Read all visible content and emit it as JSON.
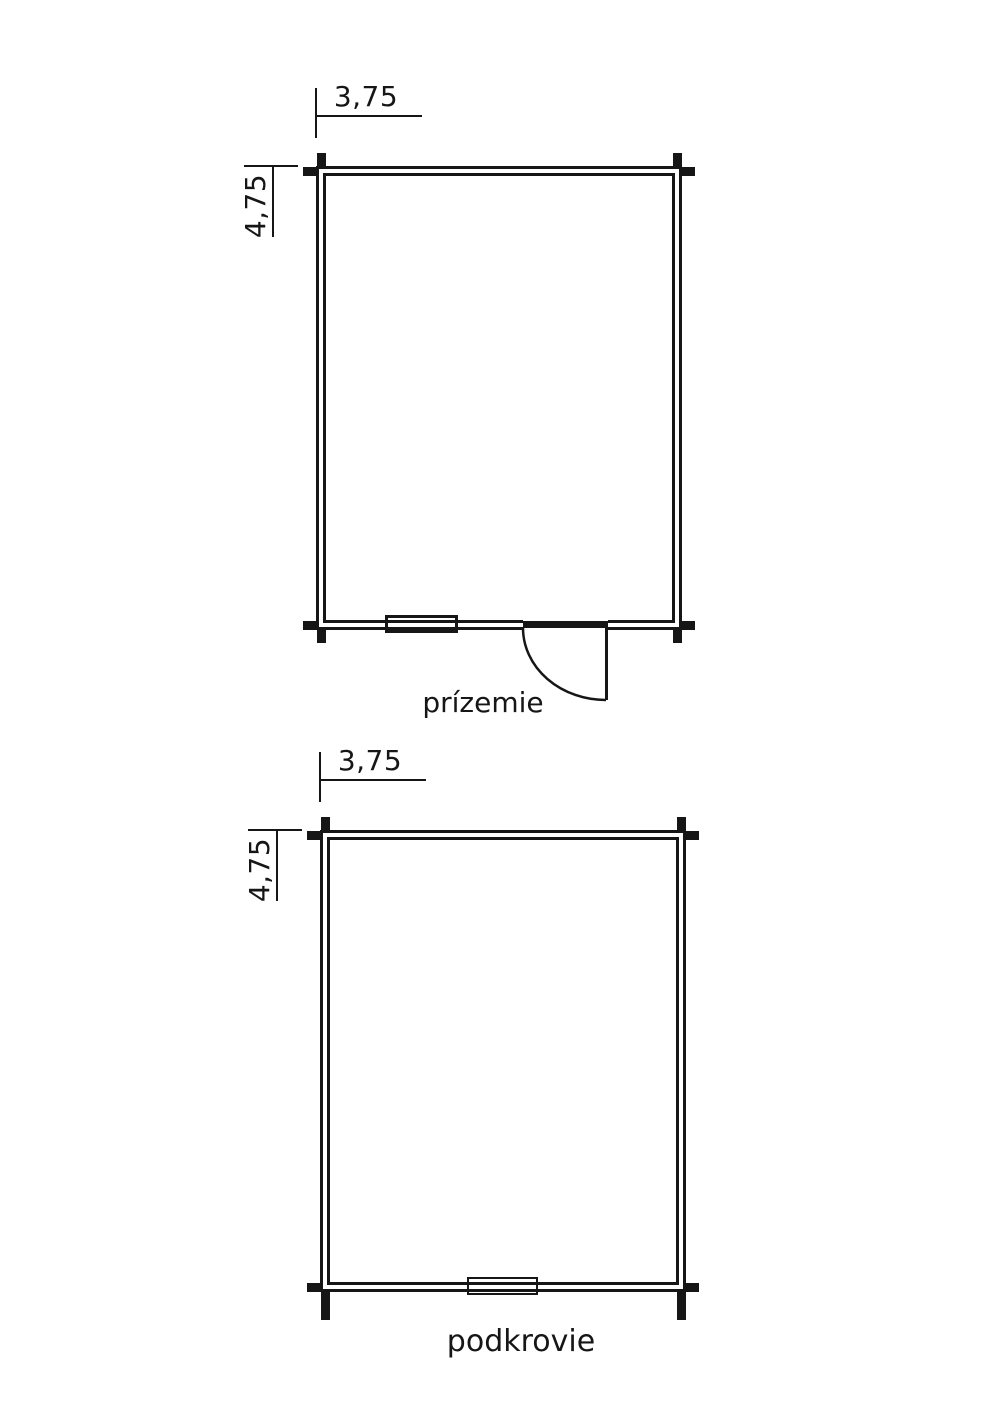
{
  "drawing": {
    "colors": {
      "line": "#161616",
      "background": "#ffffff"
    },
    "floors": [
      {
        "label": "prízemie",
        "width_m": "3,75",
        "depth_m": "4,75",
        "features": [
          "window",
          "door-with-swing"
        ]
      },
      {
        "label": "podkrovie",
        "width_m": "3,75",
        "depth_m": "4,75",
        "features": [
          "window"
        ]
      }
    ]
  }
}
